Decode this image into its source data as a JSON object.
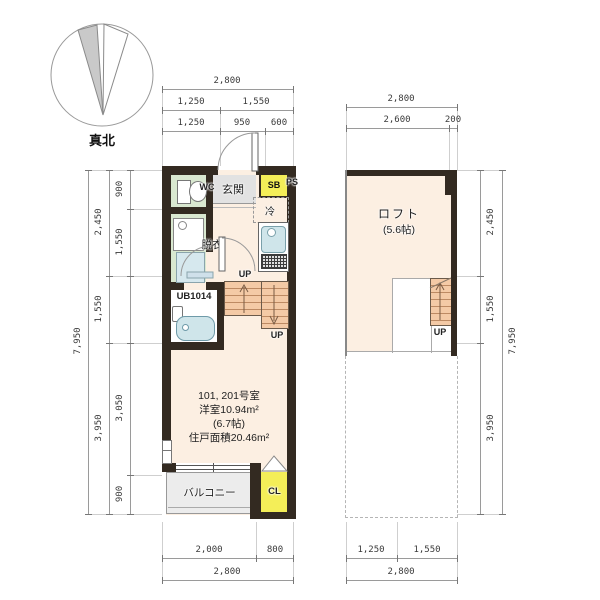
{
  "compass": {
    "label": "真北"
  },
  "floor1": {
    "dim_top_total": "2,800",
    "dim_top_r2": [
      "1,250",
      "1,550"
    ],
    "dim_top_r3": [
      "1,250",
      "950",
      "600"
    ],
    "dim_left_total": "7,950",
    "dim_left_mid": [
      "2,450",
      "1,550",
      "3,950"
    ],
    "dim_left_inner": [
      "900",
      "1,550",
      "3,050",
      "900"
    ],
    "dim_bottom_r1": [
      "2,000",
      "800"
    ],
    "dim_bottom_total": "2,800",
    "labels": {
      "wc": "WC",
      "genkan": "玄関",
      "sb": "SB",
      "ps": "PS",
      "rei": "冷",
      "datsui": "脱衣",
      "ub": "UB1014",
      "up_mid": "UP",
      "up_low": "UP",
      "balcony": "バルコニー",
      "cl": "CL"
    },
    "room_text": [
      "101, 201号室",
      "洋室10.94m²",
      "(6.7帖)",
      "住戸面積20.46m²"
    ]
  },
  "floor2": {
    "dim_top_total": "2,800",
    "dim_top_r2": [
      "2,600",
      "200"
    ],
    "dim_right_mid": [
      "2,450",
      "1,550",
      "3,950"
    ],
    "dim_right_total": "7,950",
    "dim_bottom_r1": [
      "1,250",
      "1,550"
    ],
    "dim_bottom_total": "2,800",
    "labels": {
      "loft_name": "ロフト",
      "loft_size": "(5.6帖)",
      "up": "UP"
    }
  },
  "colors": {
    "wall": "#332a21",
    "cream": "#fcefe2",
    "green": "#d9e8d0",
    "graytile": "#e2e2e2",
    "yellow": "#f4ee58",
    "stair": "#f4caa6",
    "blue": "#cfe5ea",
    "balcony": "#ececec"
  }
}
